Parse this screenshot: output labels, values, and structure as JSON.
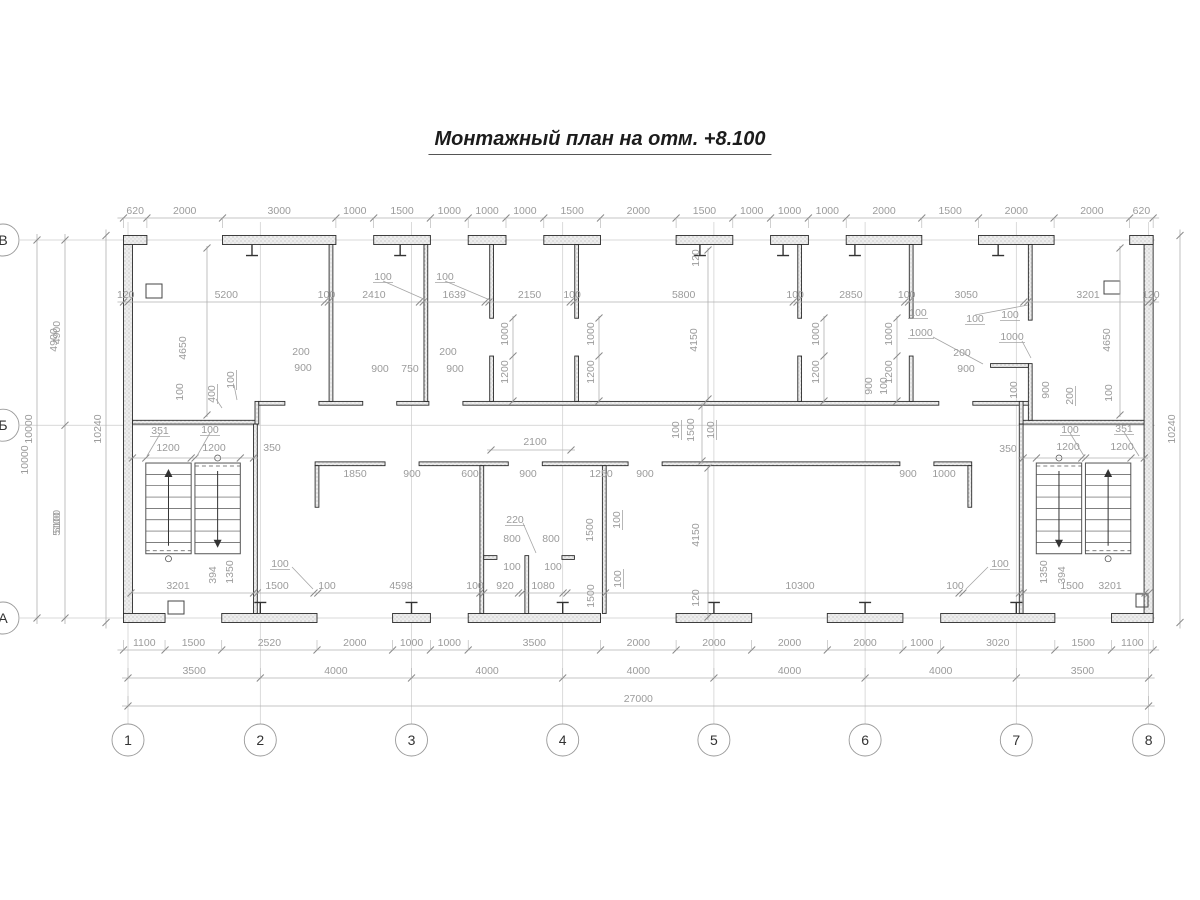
{
  "title": "Монтажный план на отм. +8.100",
  "colors": {
    "wall_stroke": "#2b2b2b",
    "wall_fill_pattern": "#ededed",
    "dim_line": "#b0b0b0",
    "dim_text": "#9b9b9b",
    "axis_line": "#cccccc",
    "circle_stroke": "#999999",
    "circle_text": "#333333",
    "stair_stroke": "#555555"
  },
  "plan": {
    "scale": 0.0378,
    "origin_x": 128,
    "origin_y": 240,
    "walls_mm": [
      [
        -120,
        -120,
        240,
        10240
      ],
      [
        26880,
        -120,
        240,
        10240
      ],
      [
        -120,
        -120,
        620,
        240
      ],
      [
        26500,
        -120,
        620,
        240
      ],
      [
        2500,
        -120,
        3000,
        240
      ],
      [
        6500,
        -120,
        1500,
        240
      ],
      [
        9000,
        -120,
        1000,
        240
      ],
      [
        11000,
        -120,
        1500,
        240
      ],
      [
        14500,
        -120,
        1500,
        240
      ],
      [
        17000,
        -120,
        1000,
        240
      ],
      [
        19000,
        -120,
        2000,
        240
      ],
      [
        22500,
        -120,
        2000,
        240
      ],
      [
        -120,
        9880,
        1100,
        240
      ],
      [
        2480,
        9880,
        2520,
        240
      ],
      [
        7000,
        9880,
        1000,
        240
      ],
      [
        9000,
        9880,
        3500,
        240
      ],
      [
        14500,
        9880,
        2000,
        240
      ],
      [
        18500,
        9880,
        2000,
        240
      ],
      [
        21500,
        9880,
        3020,
        240
      ],
      [
        26020,
        9880,
        1100,
        240
      ],
      [
        120,
        4770,
        3240,
        100
      ],
      [
        3360,
        4270,
        100,
        600
      ],
      [
        3460,
        4270,
        690,
        100
      ],
      [
        5050,
        4270,
        1160,
        100
      ],
      [
        7110,
        4270,
        850,
        100
      ],
      [
        8860,
        4270,
        12590,
        100
      ],
      [
        22350,
        4270,
        1519,
        100
      ],
      [
        23679,
        4770,
        3201,
        100
      ],
      [
        23579,
        4270,
        100,
        600
      ],
      [
        5320,
        120,
        100,
        4150
      ],
      [
        7830,
        120,
        100,
        4150
      ],
      [
        9569,
        120,
        100,
        1950
      ],
      [
        9569,
        3070,
        100,
        1200
      ],
      [
        11819,
        120,
        100,
        1950
      ],
      [
        11819,
        3070,
        100,
        1200
      ],
      [
        17719,
        120,
        100,
        1950
      ],
      [
        17719,
        3070,
        100,
        1200
      ],
      [
        20669,
        120,
        100,
        1950
      ],
      [
        20669,
        3070,
        100,
        1200
      ],
      [
        23819,
        120,
        100,
        2000
      ],
      [
        23819,
        3270,
        100,
        1500
      ],
      [
        22819,
        3270,
        1000,
        100
      ],
      [
        4950,
        5870,
        1850,
        100
      ],
      [
        7700,
        5870,
        2360,
        100
      ],
      [
        10960,
        5870,
        2270,
        100
      ],
      [
        14130,
        5870,
        6290,
        100
      ],
      [
        21320,
        5870,
        1000,
        100
      ],
      [
        4950,
        5970,
        100,
        1100
      ],
      [
        22220,
        5970,
        100,
        1100
      ],
      [
        9310,
        5970,
        100,
        3910
      ],
      [
        12550,
        5970,
        100,
        3910
      ],
      [
        10500,
        8350,
        100,
        1530
      ],
      [
        9410,
        8350,
        350,
        100
      ],
      [
        11480,
        8350,
        330,
        100
      ],
      [
        3321,
        4870,
        100,
        5010
      ],
      [
        23579,
        4870,
        100,
        5010
      ]
    ],
    "squares_px": [
      [
        146,
        284,
        16,
        14
      ],
      [
        1104,
        281,
        16,
        13
      ],
      [
        168,
        601,
        16,
        13
      ],
      [
        1136,
        594,
        12,
        13
      ]
    ],
    "columns_top_mm": [
      3280,
      7200,
      15130,
      17330,
      19230,
      23020
    ],
    "columns_bottom_mm": [
      3500,
      7500,
      11500,
      15500,
      19500,
      23500
    ],
    "stairs": [
      {
        "y1": 5900,
        "y2": 8300,
        "flights": [
          {
            "x1": 471,
            "x2": 1671,
            "arrow": "up",
            "dash": "bottom"
          },
          {
            "x1": 1771,
            "x2": 2971,
            "arrow": "down",
            "dash": "top"
          }
        ]
      },
      {
        "y1": 5900,
        "y2": 8300,
        "flights": [
          {
            "x1": 24029,
            "x2": 25229,
            "arrow": "down",
            "dash": "top"
          },
          {
            "x1": 25329,
            "x2": 26529,
            "arrow": "up",
            "dash": "bottom"
          }
        ]
      }
    ]
  },
  "axes": {
    "vertical": [
      {
        "label": "1",
        "mm": 0
      },
      {
        "label": "2",
        "mm": 3500
      },
      {
        "label": "3",
        "mm": 7500
      },
      {
        "label": "4",
        "mm": 11500
      },
      {
        "label": "5",
        "mm": 15500
      },
      {
        "label": "6",
        "mm": 19500
      },
      {
        "label": "7",
        "mm": 23500
      },
      {
        "label": "8",
        "mm": 27000
      }
    ],
    "horizontal": [
      {
        "label": "В",
        "mm": 0
      },
      {
        "label": "Б",
        "mm": 4900
      },
      {
        "label": "А",
        "mm": 10000
      }
    ],
    "circle_row_y": 740,
    "circle_left_x": 3,
    "circle_r": 16
  },
  "chains": [
    {
      "dir": "h",
      "pos": 218,
      "start": -120,
      "ext": 1,
      "segs": [
        620,
        2000,
        3000,
        1000,
        1500,
        1000,
        1000,
        1000,
        1500,
        2000,
        1500,
        1000,
        1000,
        1000,
        2000,
        1500,
        2000,
        2000,
        620
      ]
    },
    {
      "dir": "h",
      "pos": 302,
      "start": -120,
      "ext": 0,
      "segs": [
        120,
        5200,
        100,
        2410,
        {
          "v": 100,
          "skip": 1
        },
        1639,
        {
          "v": 100,
          "skip": 1
        },
        2150,
        100,
        5800,
        100,
        2850,
        100,
        3050,
        {
          "v": 100,
          "skip": 1
        },
        3201,
        120
      ]
    },
    {
      "dir": "h",
      "pos": 650,
      "start": -120,
      "ext": -1,
      "segs": [
        1100,
        1500,
        2520,
        2000,
        1000,
        1000,
        3500,
        2000,
        2000,
        2000,
        2000,
        1000,
        3020,
        1500,
        1100
      ]
    },
    {
      "dir": "h",
      "pos": 678,
      "start": 0,
      "ext": -1,
      "segs": [
        3500,
        4000,
        4000,
        4000,
        4000,
        4000,
        3500
      ]
    },
    {
      "dir": "h",
      "pos": 706,
      "start": 0,
      "ext": -1,
      "segs": [
        27000
      ]
    },
    {
      "dir": "v",
      "pos": 65,
      "start": 0,
      "ext": 0,
      "segs": [
        4900,
        5100
      ]
    },
    {
      "dir": "v",
      "pos": 37,
      "start": 0,
      "ext": 0,
      "segs": [
        10000
      ]
    },
    {
      "dir": "v",
      "pos": 106,
      "start": -120,
      "ext": 0,
      "segs": [
        {
          "v": 10240,
          "label": "10240"
        }
      ]
    },
    {
      "dir": "v",
      "pos": 1180,
      "start": -120,
      "ext": 0,
      "segs": [
        {
          "v": 10240,
          "label": "10240"
        }
      ]
    }
  ],
  "dimlines": [
    {
      "x1": 207,
      "y1": 246,
      "x2": 207,
      "y2": 417,
      "ticks": [
        [
          207,
          248
        ],
        [
          207,
          415
        ]
      ]
    },
    {
      "x1": 1120,
      "y1": 246,
      "x2": 1120,
      "y2": 417,
      "ticks": [
        [
          1120,
          248
        ],
        [
          1120,
          415
        ]
      ]
    },
    {
      "x1": 708,
      "y1": 248,
      "x2": 708,
      "y2": 401,
      "ticks": [
        [
          708,
          250
        ],
        [
          708,
          399
        ]
      ]
    },
    {
      "x1": 708,
      "y1": 466,
      "x2": 708,
      "y2": 620,
      "ticks": [
        [
          708,
          468
        ],
        [
          708,
          617
        ]
      ]
    },
    {
      "x1": 702,
      "y1": 403,
      "x2": 702,
      "y2": 464,
      "ticks": [
        [
          702,
          406
        ],
        [
          702,
          461
        ]
      ]
    },
    {
      "x1": 513,
      "y1": 316,
      "x2": 513,
      "y2": 403,
      "ticks": [
        [
          513,
          318
        ],
        [
          513,
          356
        ],
        [
          513,
          401
        ]
      ]
    },
    {
      "x1": 599,
      "y1": 316,
      "x2": 599,
      "y2": 403,
      "ticks": [
        [
          599,
          318
        ],
        [
          599,
          356
        ],
        [
          599,
          401
        ]
      ]
    },
    {
      "x1": 824,
      "y1": 316,
      "x2": 824,
      "y2": 403,
      "ticks": [
        [
          824,
          318
        ],
        [
          824,
          356
        ],
        [
          824,
          401
        ]
      ]
    },
    {
      "x1": 897,
      "y1": 316,
      "x2": 897,
      "y2": 403,
      "ticks": [
        [
          897,
          318
        ],
        [
          897,
          356
        ],
        [
          897,
          401
        ]
      ]
    },
    {
      "x1": 487,
      "y1": 450,
      "x2": 575,
      "y2": 450,
      "ticks": [
        [
          491,
          450
        ],
        [
          571,
          450
        ]
      ]
    },
    {
      "x1": 128,
      "y1": 458,
      "x2": 258,
      "y2": 458,
      "ticks": [
        [
          132.5,
          458
        ],
        [
          145.8,
          458
        ],
        [
          191.2,
          458
        ],
        [
          195,
          458
        ],
        [
          240.3,
          458
        ],
        [
          253.5,
          458
        ]
      ]
    },
    {
      "x1": 1018,
      "y1": 458,
      "x2": 1148,
      "y2": 458,
      "ticks": [
        [
          1023.2,
          458
        ],
        [
          1036.4,
          458
        ],
        [
          1081.8,
          458
        ],
        [
          1085.6,
          458
        ],
        [
          1131,
          458
        ],
        [
          1144.3,
          458
        ]
      ]
    },
    {
      "x1": 131,
      "y1": 593,
      "x2": 1149,
      "y2": 593,
      "ticks": [
        [
          131,
          593
        ],
        [
          253.5,
          593
        ],
        [
          257.3,
          593
        ],
        [
          314,
          593
        ],
        [
          317.8,
          593
        ],
        [
          479.9,
          593
        ],
        [
          483.7,
          593
        ],
        [
          518.5,
          593
        ],
        [
          522.3,
          593
        ],
        [
          563.1,
          593
        ],
        [
          566.9,
          593
        ],
        [
          605.5,
          593
        ],
        [
          959.1,
          593
        ],
        [
          962.9,
          593
        ],
        [
          1019.4,
          593
        ],
        [
          1023.2,
          593
        ],
        [
          1145,
          593
        ],
        [
          1149,
          593
        ]
      ]
    }
  ],
  "labels": [
    {
      "t": "100",
      "x": 383,
      "y": 277,
      "u": 1
    },
    {
      "t": "100",
      "x": 445,
      "y": 277,
      "u": 1
    },
    {
      "t": "100",
      "x": 975,
      "y": 319,
      "u": 1
    },
    {
      "t": "120",
      "x": 696,
      "y": 258,
      "r": 1
    },
    {
      "t": "4150",
      "x": 694,
      "y": 340,
      "r": 1
    },
    {
      "t": "4650",
      "x": 183,
      "y": 348,
      "r": 1
    },
    {
      "t": "100",
      "x": 180,
      "y": 392,
      "r": 1
    },
    {
      "t": "400",
      "x": 212,
      "y": 394,
      "r": 1,
      "u": 1
    },
    {
      "t": "100",
      "x": 231,
      "y": 380,
      "r": 1,
      "u": 1
    },
    {
      "t": "200",
      "x": 301,
      "y": 352
    },
    {
      "t": "900",
      "x": 303,
      "y": 368
    },
    {
      "t": "900",
      "x": 380,
      "y": 369
    },
    {
      "t": "750",
      "x": 410,
      "y": 369
    },
    {
      "t": "200",
      "x": 448,
      "y": 352
    },
    {
      "t": "900",
      "x": 455,
      "y": 369
    },
    {
      "t": "1000",
      "x": 505,
      "y": 334,
      "r": 1
    },
    {
      "t": "1200",
      "x": 505,
      "y": 372,
      "r": 1
    },
    {
      "t": "1000",
      "x": 591,
      "y": 334,
      "r": 1
    },
    {
      "t": "1200",
      "x": 591,
      "y": 372,
      "r": 1
    },
    {
      "t": "1000",
      "x": 816,
      "y": 334,
      "r": 1
    },
    {
      "t": "1200",
      "x": 816,
      "y": 372,
      "r": 1
    },
    {
      "t": "1000",
      "x": 889,
      "y": 334,
      "r": 1
    },
    {
      "t": "1200",
      "x": 889,
      "y": 372,
      "r": 1
    },
    {
      "t": "900",
      "x": 869,
      "y": 386,
      "r": 1
    },
    {
      "t": "100",
      "x": 884,
      "y": 386,
      "r": 1
    },
    {
      "t": "100",
      "x": 918,
      "y": 313,
      "u": 1
    },
    {
      "t": "1000",
      "x": 921,
      "y": 333,
      "u": 1
    },
    {
      "t": "100",
      "x": 1010,
      "y": 315,
      "u": 1
    },
    {
      "t": "1000",
      "x": 1012,
      "y": 337,
      "u": 1
    },
    {
      "t": "200",
      "x": 962,
      "y": 353
    },
    {
      "t": "900",
      "x": 966,
      "y": 369
    },
    {
      "t": "900",
      "x": 1046,
      "y": 390,
      "r": 1
    },
    {
      "t": "100",
      "x": 1014,
      "y": 390,
      "r": 1
    },
    {
      "t": "200",
      "x": 1070,
      "y": 396,
      "r": 1,
      "u": 1
    },
    {
      "t": "4650",
      "x": 1107,
      "y": 340,
      "r": 1
    },
    {
      "t": "100",
      "x": 1109,
      "y": 393,
      "r": 1
    },
    {
      "t": "351",
      "x": 160,
      "y": 431,
      "u": 1
    },
    {
      "t": "1200",
      "x": 168,
      "y": 448
    },
    {
      "t": "100",
      "x": 210,
      "y": 430,
      "u": 1
    },
    {
      "t": "1200",
      "x": 214,
      "y": 448
    },
    {
      "t": "350",
      "x": 272,
      "y": 448
    },
    {
      "t": "350",
      "x": 1008,
      "y": 449
    },
    {
      "t": "100",
      "x": 1070,
      "y": 430,
      "u": 1
    },
    {
      "t": "1200",
      "x": 1068,
      "y": 447
    },
    {
      "t": "351",
      "x": 1124,
      "y": 429,
      "u": 1
    },
    {
      "t": "1200",
      "x": 1122,
      "y": 447
    },
    {
      "t": "100",
      "x": 676,
      "y": 430,
      "r": 1,
      "u": 1
    },
    {
      "t": "1500",
      "x": 691,
      "y": 430,
      "r": 1
    },
    {
      "t": "100",
      "x": 711,
      "y": 430,
      "r": 1,
      "u": 1
    },
    {
      "t": "1850",
      "x": 355,
      "y": 474
    },
    {
      "t": "900",
      "x": 412,
      "y": 474
    },
    {
      "t": "600",
      "x": 470,
      "y": 474
    },
    {
      "t": "2100",
      "x": 535,
      "y": 442
    },
    {
      "t": "900",
      "x": 528,
      "y": 474
    },
    {
      "t": "1250",
      "x": 601,
      "y": 474
    },
    {
      "t": "900",
      "x": 645,
      "y": 474
    },
    {
      "t": "900",
      "x": 908,
      "y": 474
    },
    {
      "t": "1000",
      "x": 944,
      "y": 474
    },
    {
      "t": "4150",
      "x": 696,
      "y": 535,
      "r": 1
    },
    {
      "t": "120",
      "x": 696,
      "y": 598,
      "r": 1
    },
    {
      "t": "220",
      "x": 515,
      "y": 520,
      "u": 1
    },
    {
      "t": "800",
      "x": 512,
      "y": 539
    },
    {
      "t": "800",
      "x": 551,
      "y": 539
    },
    {
      "t": "1500",
      "x": 590,
      "y": 530,
      "r": 1
    },
    {
      "t": "100",
      "x": 617,
      "y": 520,
      "r": 1,
      "u": 1
    },
    {
      "t": "100",
      "x": 512,
      "y": 567
    },
    {
      "t": "100",
      "x": 553,
      "y": 567
    },
    {
      "t": "1500",
      "x": 591,
      "y": 596,
      "r": 1
    },
    {
      "t": "100",
      "x": 618,
      "y": 579,
      "r": 1,
      "u": 1
    },
    {
      "t": "3201",
      "x": 178,
      "y": 586
    },
    {
      "t": "394",
      "x": 213,
      "y": 575,
      "r": 1
    },
    {
      "t": "1350",
      "x": 230,
      "y": 572,
      "r": 1
    },
    {
      "t": "100",
      "x": 280,
      "y": 564,
      "u": 1
    },
    {
      "t": "1500",
      "x": 277,
      "y": 586
    },
    {
      "t": "100",
      "x": 327,
      "y": 586
    },
    {
      "t": "4598",
      "x": 401,
      "y": 586
    },
    {
      "t": "100",
      "x": 475,
      "y": 586
    },
    {
      "t": "920",
      "x": 505,
      "y": 586
    },
    {
      "t": "1080",
      "x": 543,
      "y": 586
    },
    {
      "t": "10300",
      "x": 800,
      "y": 586
    },
    {
      "t": "100",
      "x": 955,
      "y": 586
    },
    {
      "t": "100",
      "x": 1000,
      "y": 564,
      "u": 1
    },
    {
      "t": "1500",
      "x": 1072,
      "y": 586
    },
    {
      "t": "1350",
      "x": 1044,
      "y": 572,
      "r": 1
    },
    {
      "t": "394",
      "x": 1062,
      "y": 575,
      "r": 1
    },
    {
      "t": "3201",
      "x": 1110,
      "y": 586
    },
    {
      "t": "4900",
      "x": 54,
      "y": 340,
      "r": 1
    },
    {
      "t": "5100",
      "x": 57,
      "y": 524,
      "r": 1
    },
    {
      "t": "10000",
      "x": 25,
      "y": 460,
      "r": 1
    }
  ],
  "leaders": [
    [
      383,
      281,
      426,
      300
    ],
    [
      445,
      281,
      490,
      300
    ],
    [
      975,
      315,
      1028,
      305
    ],
    [
      292,
      567,
      313,
      589
    ],
    [
      988,
      567,
      966,
      589
    ],
    [
      523,
      523,
      536,
      553
    ],
    [
      216,
      399,
      222,
      408
    ],
    [
      234,
      385,
      237,
      400
    ],
    [
      933,
      337,
      983,
      364
    ],
    [
      1022,
      341,
      1031,
      358
    ],
    [
      160,
      434,
      147,
      456
    ],
    [
      210,
      433,
      197,
      456
    ],
    [
      1070,
      433,
      1084,
      456
    ],
    [
      1124,
      432,
      1139,
      456
    ]
  ]
}
